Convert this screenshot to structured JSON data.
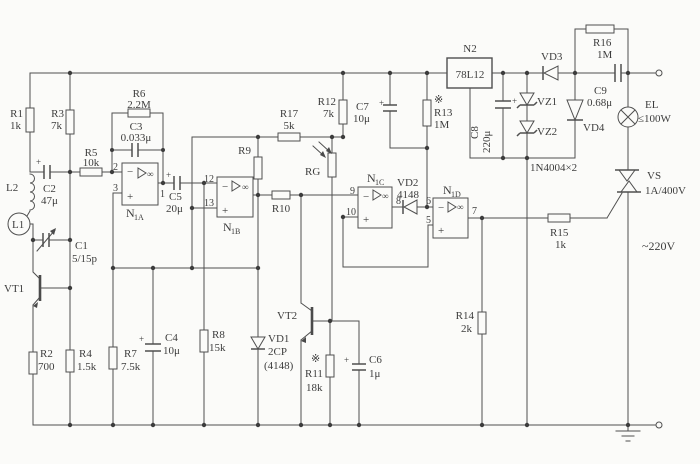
{
  "diagram": {
    "kind": "analog light-control circuit schematic",
    "ink": "#4a4a4a",
    "paper": "#fbfbf9"
  },
  "labels": {
    "r1": {
      "n": "R1",
      "v": "1k"
    },
    "r2": {
      "n": "R2",
      "v": "700"
    },
    "r3": {
      "n": "R3",
      "v": "7k"
    },
    "r4": {
      "n": "R4",
      "v": "1.5k"
    },
    "r5": {
      "n": "R5",
      "v": "10k"
    },
    "r6": {
      "n": "R6",
      "v": "2.2M"
    },
    "r7": {
      "n": "R7",
      "v": "7.5k"
    },
    "r8": {
      "n": "R8",
      "v": "15k"
    },
    "r9": {
      "n": "R9"
    },
    "r10": {
      "n": "R10"
    },
    "r11": {
      "n": "R11",
      "v": "18k"
    },
    "r12": {
      "n": "R12",
      "v": "7k"
    },
    "r13": {
      "n": "R13",
      "v": "1M"
    },
    "r14": {
      "n": "R14",
      "v": "2k"
    },
    "r15": {
      "n": "R15",
      "v": "1k"
    },
    "r16": {
      "n": "R16",
      "v": "1M"
    },
    "r17": {
      "n": "R17",
      "v": "5k"
    },
    "c1": {
      "n": "C1",
      "v": "5/15p"
    },
    "c2": {
      "n": "C2",
      "v": "47μ"
    },
    "c3": {
      "n": "C3",
      "v": "0.033μ"
    },
    "c4": {
      "n": "C4",
      "v": "10μ"
    },
    "c5": {
      "n": "C5",
      "v": "20μ"
    },
    "c6": {
      "n": "C6",
      "v": "1μ"
    },
    "c7": {
      "n": "C7",
      "v": "10μ"
    },
    "c8": {
      "n": "C8",
      "v": "220μ"
    },
    "c9": {
      "n": "C9",
      "v": "0.68μ"
    },
    "l1": {
      "n": "L1"
    },
    "l2": {
      "n": "L2"
    },
    "vt1": {
      "n": "VT1"
    },
    "vt2": {
      "n": "VT2"
    },
    "vd1": {
      "n": "VD1",
      "v": "2CP",
      "v2": "(4148)"
    },
    "vd2": {
      "n": "VD2",
      "v": "4148"
    },
    "vd3": {
      "n": "VD3"
    },
    "vd4": {
      "n": "VD4"
    },
    "vz1": {
      "n": "VZ1"
    },
    "vz2": {
      "n": "VZ2"
    },
    "rg": {
      "n": "RG"
    },
    "el": {
      "n": "EL",
      "v": "≤100W"
    },
    "vs": {
      "n": "VS",
      "v": "1A/400V"
    },
    "n2": {
      "n": "N2",
      "v": "78L12"
    }
  },
  "ics": {
    "n1a": {
      "p": "N",
      "s": "1A"
    },
    "n1b": {
      "p": "N",
      "s": "1B"
    },
    "n1c": {
      "p": "N",
      "s": "1C"
    },
    "n1d": {
      "p": "N",
      "s": "1D"
    }
  },
  "pins": {
    "n1a_inv": "2",
    "n1a_non": "3",
    "n1a_out": "1",
    "n1b_inv": "12",
    "n1b_non": "13",
    "n1c_inv": "9",
    "n1c_non": "10",
    "n1c_out": "8",
    "n1d_inv": "6",
    "n1d_non": "5",
    "n1d_out": "7"
  },
  "signs": {
    "inv": "−",
    "non": "+",
    "inf": "∞",
    "plus": "+",
    "star": "※"
  },
  "notes": {
    "rectifiers": "1N4004×2",
    "mains": "~220V"
  }
}
